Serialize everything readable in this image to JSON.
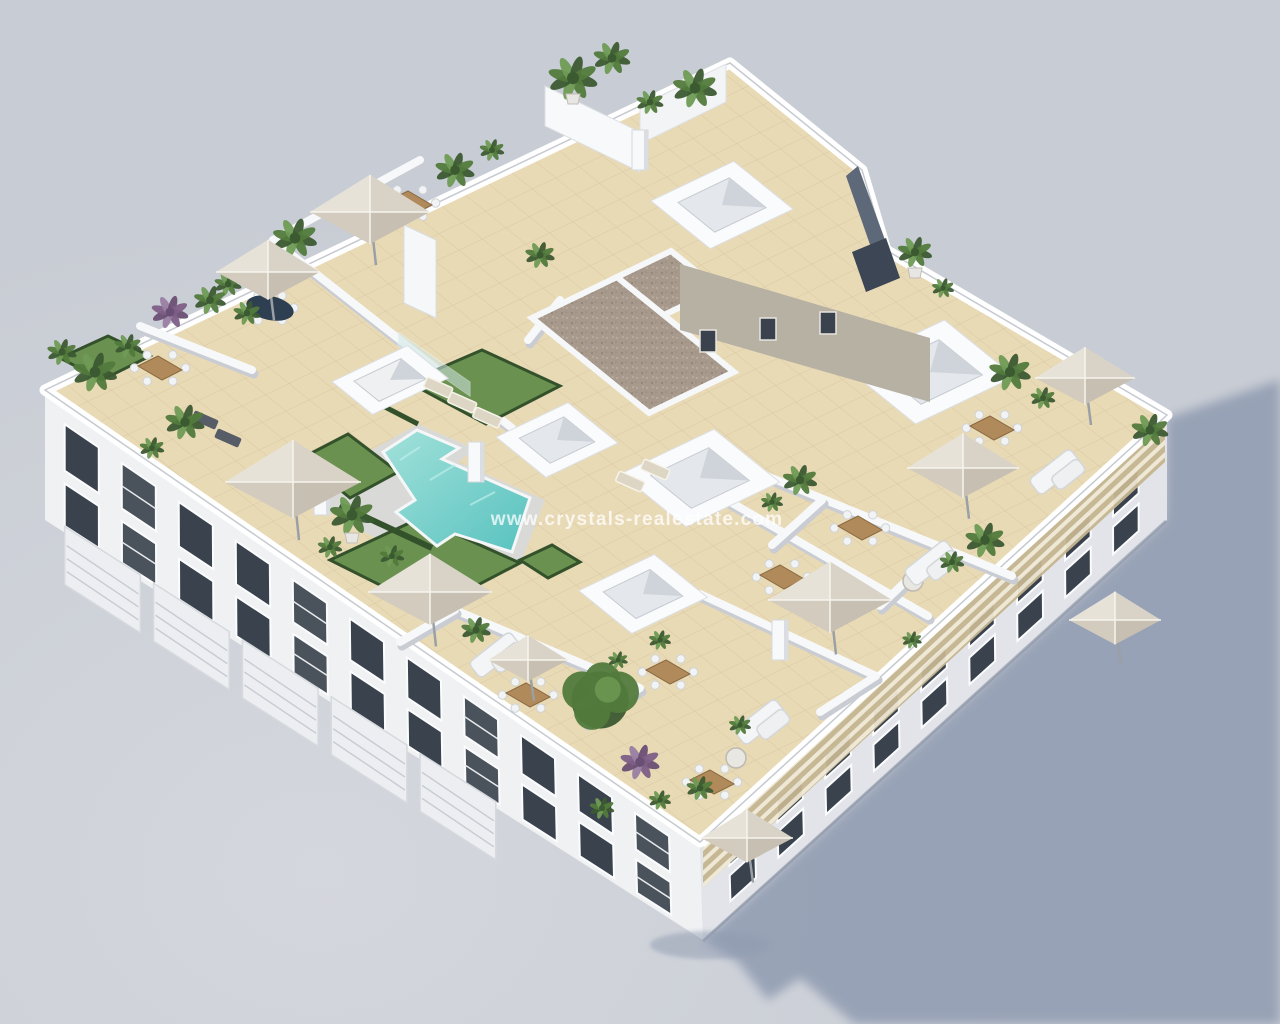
{
  "meta": {
    "kind": "3d-architectural-render",
    "subject": "aerial-view-apartment-building-rooftop-pool-terraces"
  },
  "watermark": {
    "text": "www.crystals-realestate.com",
    "color": "#ffffff",
    "opacity": 0.75,
    "font_size": 19
  },
  "colors": {
    "bg": "#c8ccd4",
    "bg_light": "#d4d7dd",
    "ground_shadow": "#8f9bb1",
    "wall_white": "#f5f6f8",
    "wall_shade": "#d7dade",
    "facade_left": "#eff1f3",
    "facade_right": "#e2e4e9",
    "window_dark": "#39424d",
    "window_frame": "#fbfcfd",
    "roof_tile": "#e9dab6",
    "tile_line": "#b49e74",
    "pool_light": "#a2e1da",
    "pool_deep": "#58c2bf",
    "pool_deck": "#d9dad7",
    "grass": "#6b9150",
    "hedge": "#33512b",
    "plant_dark": "#3c5a31",
    "plant_mid": "#527a3c",
    "plant_light": "#6f9b55",
    "plant_purple": "#7e5f88",
    "umbrella_nw": "#e7e2d8",
    "umbrella_ne": "#d9d3c7",
    "umbrella_se": "#c7c0b2",
    "umbrella_sw": "#d2cbbe",
    "wood": "#b08a5a",
    "gravel": "#a79a8d",
    "slat_dark": "#c4b591",
    "slat_light": "#efe8d4",
    "step_wall_dark": "#5d6878",
    "core_wall": "#b7b1a4",
    "table_dark": "#2e3f52"
  }
}
